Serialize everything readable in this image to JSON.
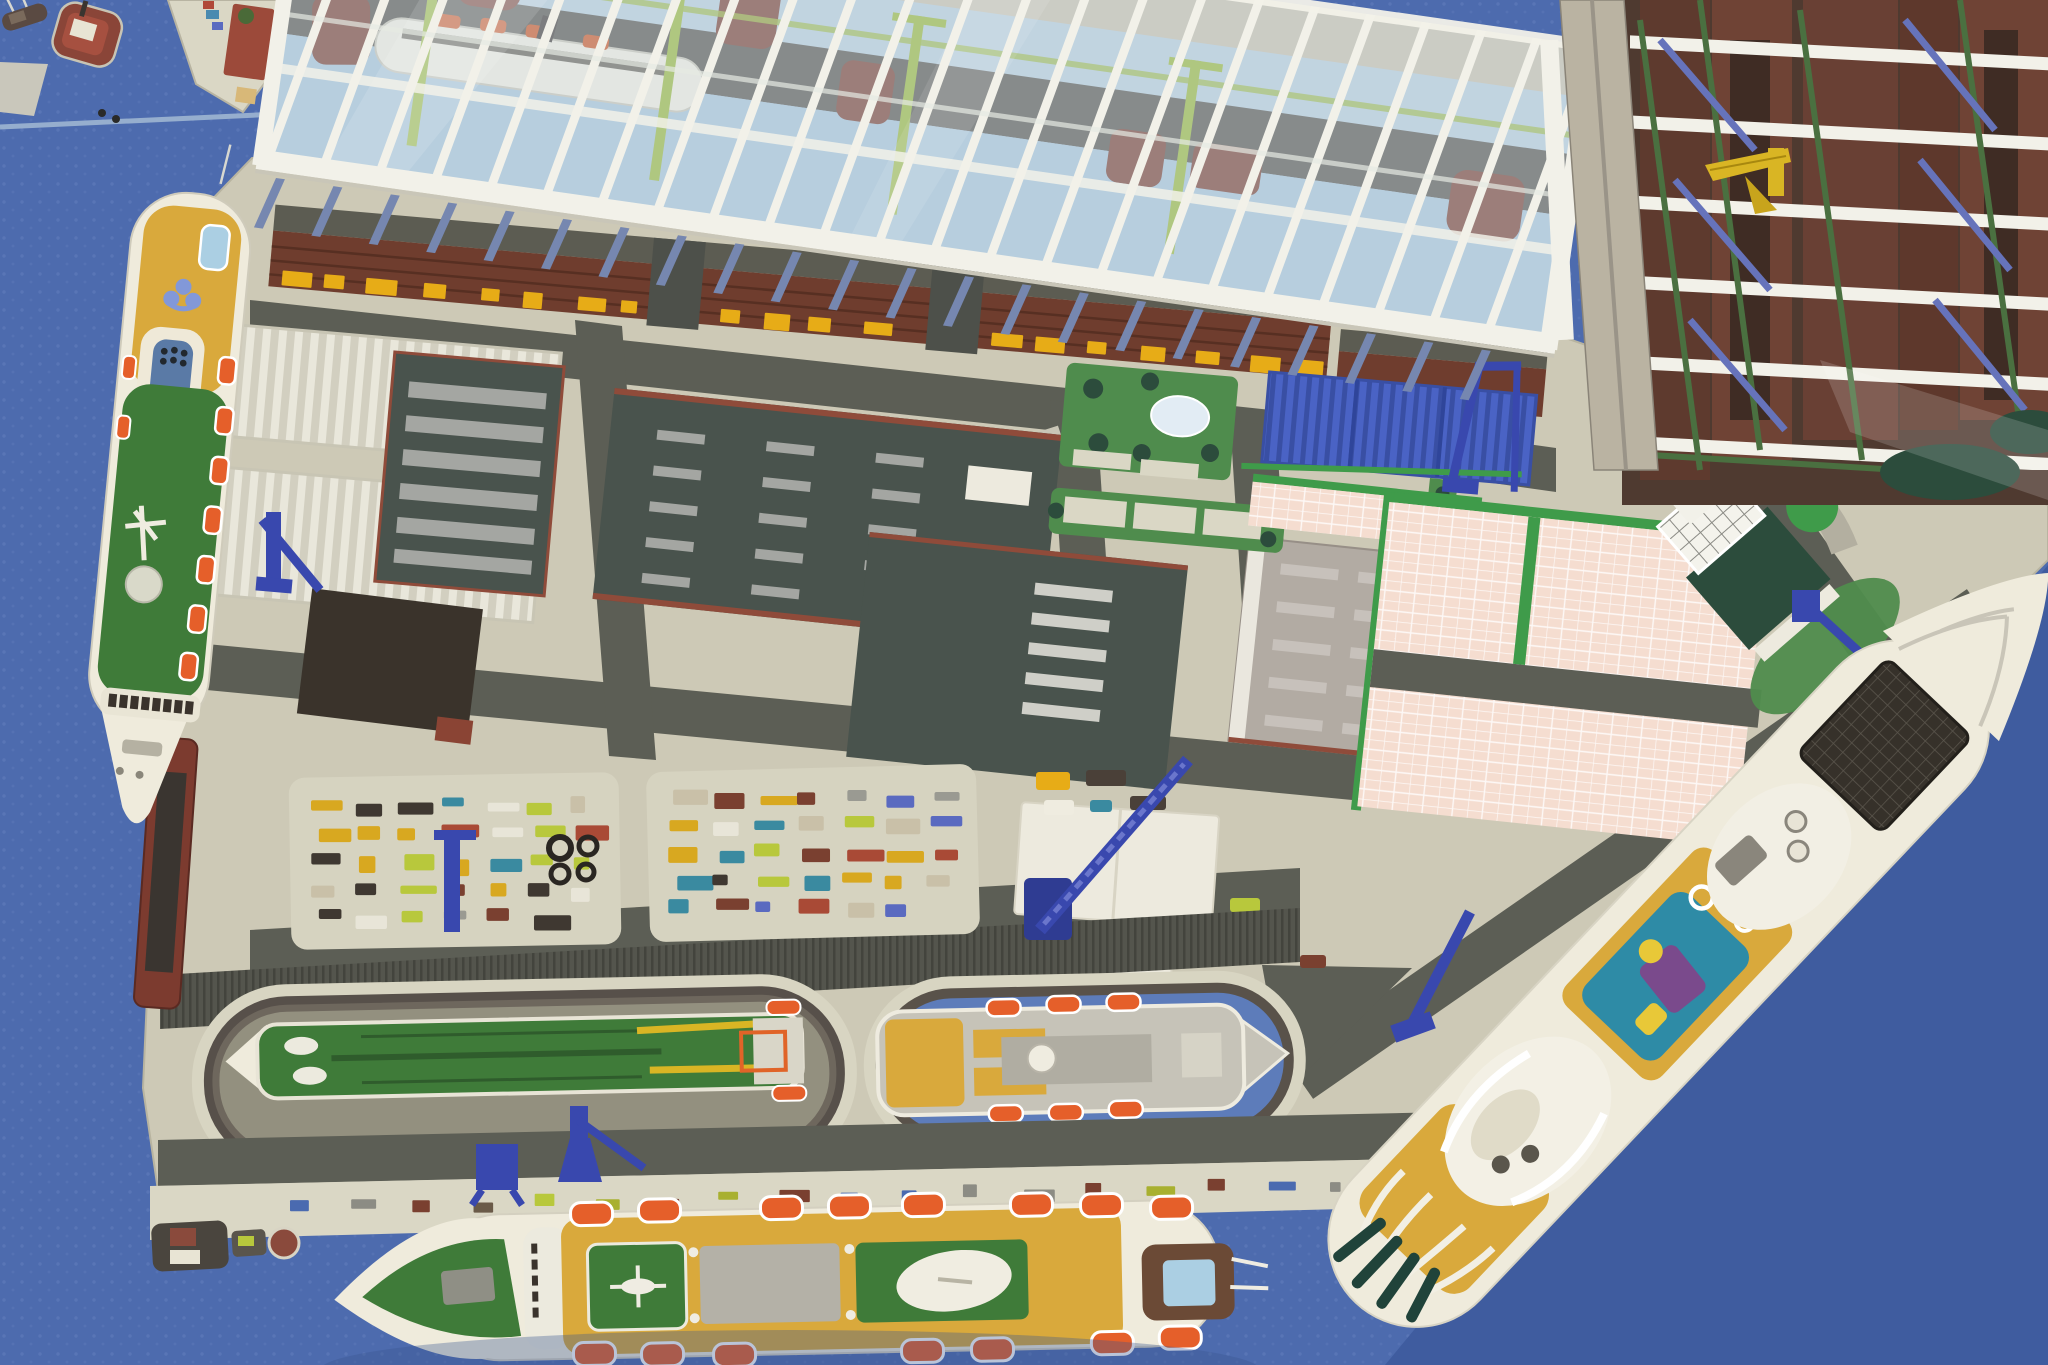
{
  "meta": {
    "title": "Aerial view of a scale-model shipyard diorama",
    "media": "photograph, no visible text"
  },
  "palette": {
    "water": "#4d6bae",
    "waterDot": "#627dbd",
    "waterDark": "#3f5c9f",
    "land": "#cdc9b6",
    "landLight": "#dad7c5",
    "road": "#5c5e55",
    "roadDark": "#4d504a",
    "warehouse": "#6f3d2e",
    "warehouseLine": "#572f22",
    "roofBand": "#5c5c52",
    "dockYellow": "#e7ac17",
    "bldgDark": "#49534d",
    "trim": "#8f4b3a",
    "bldgBrown": "#3a332b",
    "bldgGray": "#b2aba3",
    "ventSlot": "#a4a6a2",
    "ventLight": "#c7c1bb",
    "pink": "#f5ddd0",
    "lawn": "#4f8c4d",
    "greenDark": "#2c4c3c",
    "greenBright": "#3f9b4a",
    "blueCont": "#4a63c5",
    "blueContDark": "#394fa4",
    "craneBlue": "#3948ae",
    "shipWhite": "#efebdc",
    "deckGreen": "#3f7b39",
    "deckYellow": "#d9a93c",
    "lifeboat": "#e55f2a",
    "funnelBlue": "#5a7aa6",
    "poolBlue": "#abcfe3",
    "poolTeal": "#2e8ba6",
    "hullRed": "#7c4334",
    "frameWhite": "#f2f1e9",
    "hallFloor": "#a9c3d6",
    "hallBand": "#5b5850",
    "hallCol": "#7687b0",
    "solarDark": "#36312a",
    "windowGreen": "#20433a",
    "truss": "#4a7040",
    "diagBlue": "#6673bb",
    "craneYellow": "#d9b524",
    "rightDark": "#5e3a2e",
    "rightDark2": "#6f4335",
    "whitePad": "#edeade",
    "grayPad": "#b4b1a7",
    "tanRoad": "#bab3a2"
  },
  "cargo_colors": [
    "#a94a36",
    "#7a4030",
    "#3f3831",
    "#d8a820",
    "#b8c83c",
    "#e8e5d8",
    "#5a6ac0",
    "#9a9a92",
    "#3a8aa0",
    "#c9c0a8"
  ],
  "quay_item_colors": [
    "#a8b030",
    "#6a5a48",
    "#8c8c84",
    "#4a6ab0",
    "#7a4030",
    "#b8c83c"
  ],
  "scene": {
    "objects": [
      {
        "name": "glass-assembly-hall",
        "desc": "glazed shipbuilding hall with white frame, ship under construction inside"
      },
      {
        "name": "green-cruise-ship",
        "desc": "moored cruise liner, green decks, yellow stern lido, blue funnel"
      },
      {
        "name": "yellow-cruise-ship",
        "desc": "cruise liner along south quay, orange lifeboats, helipad, stern pool"
      },
      {
        "name": "modern-cruise-ship",
        "desc": "large modern cruise ship on diagonal quay, pool deck and solar panels"
      },
      {
        "name": "graving-dock-tanker",
        "desc": "green tanker in dry dock"
      },
      {
        "name": "floating-dock-ship",
        "desc": "cargo-passenger ship in flooded dock"
      },
      {
        "name": "warehouse-strip",
        "desc": "long brown warehouse row with yellow loading doors"
      },
      {
        "name": "blue-container-stack",
        "desc": "blue container block with gantry crane"
      },
      {
        "name": "pink-parking-area",
        "desc": "pink gridded storage/parking apron"
      },
      {
        "name": "gantry-structure-east",
        "desc": "building berth gantries with white beams, green trusses, yellow crane"
      },
      {
        "name": "harbor-cranes",
        "desc": "blue level-luffing cranes on quays"
      },
      {
        "name": "cargo-yard",
        "desc": "laydown pads with colorful cargo pieces"
      },
      {
        "name": "tugboat",
        "desc": "small brown tug in north-west water"
      }
    ]
  }
}
